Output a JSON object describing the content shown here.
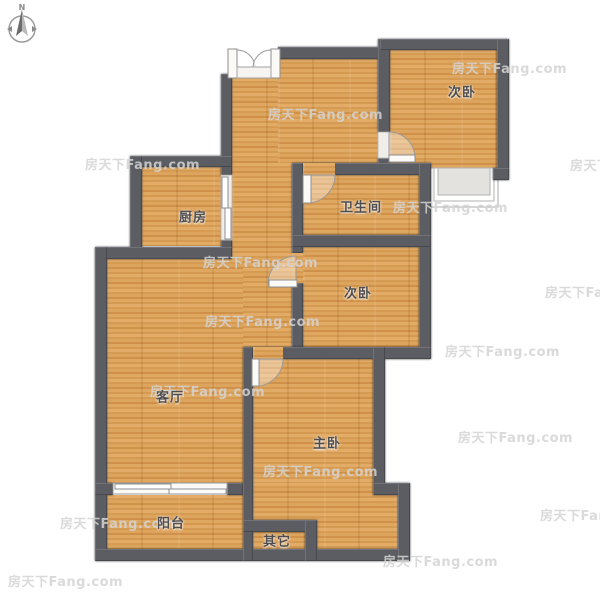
{
  "watermark": {
    "text": "房天下Fang.com"
  },
  "compass": {
    "label": "N"
  },
  "rooms": {
    "bedroom_top_right": {
      "label": "次卧"
    },
    "kitchen": {
      "label": "厨房"
    },
    "bathroom": {
      "label": "卫生间"
    },
    "bedroom_mid_right": {
      "label": "次卧"
    },
    "living": {
      "label": "客厅"
    },
    "master": {
      "label": "主卧"
    },
    "balcony": {
      "label": "阳台"
    },
    "other": {
      "label": "其它"
    }
  },
  "colors": {
    "wall": "#5b5d62",
    "floor": "#d9a15c",
    "bay_window_fill": "#e3e2df",
    "watermark": "#d4d4d4"
  }
}
